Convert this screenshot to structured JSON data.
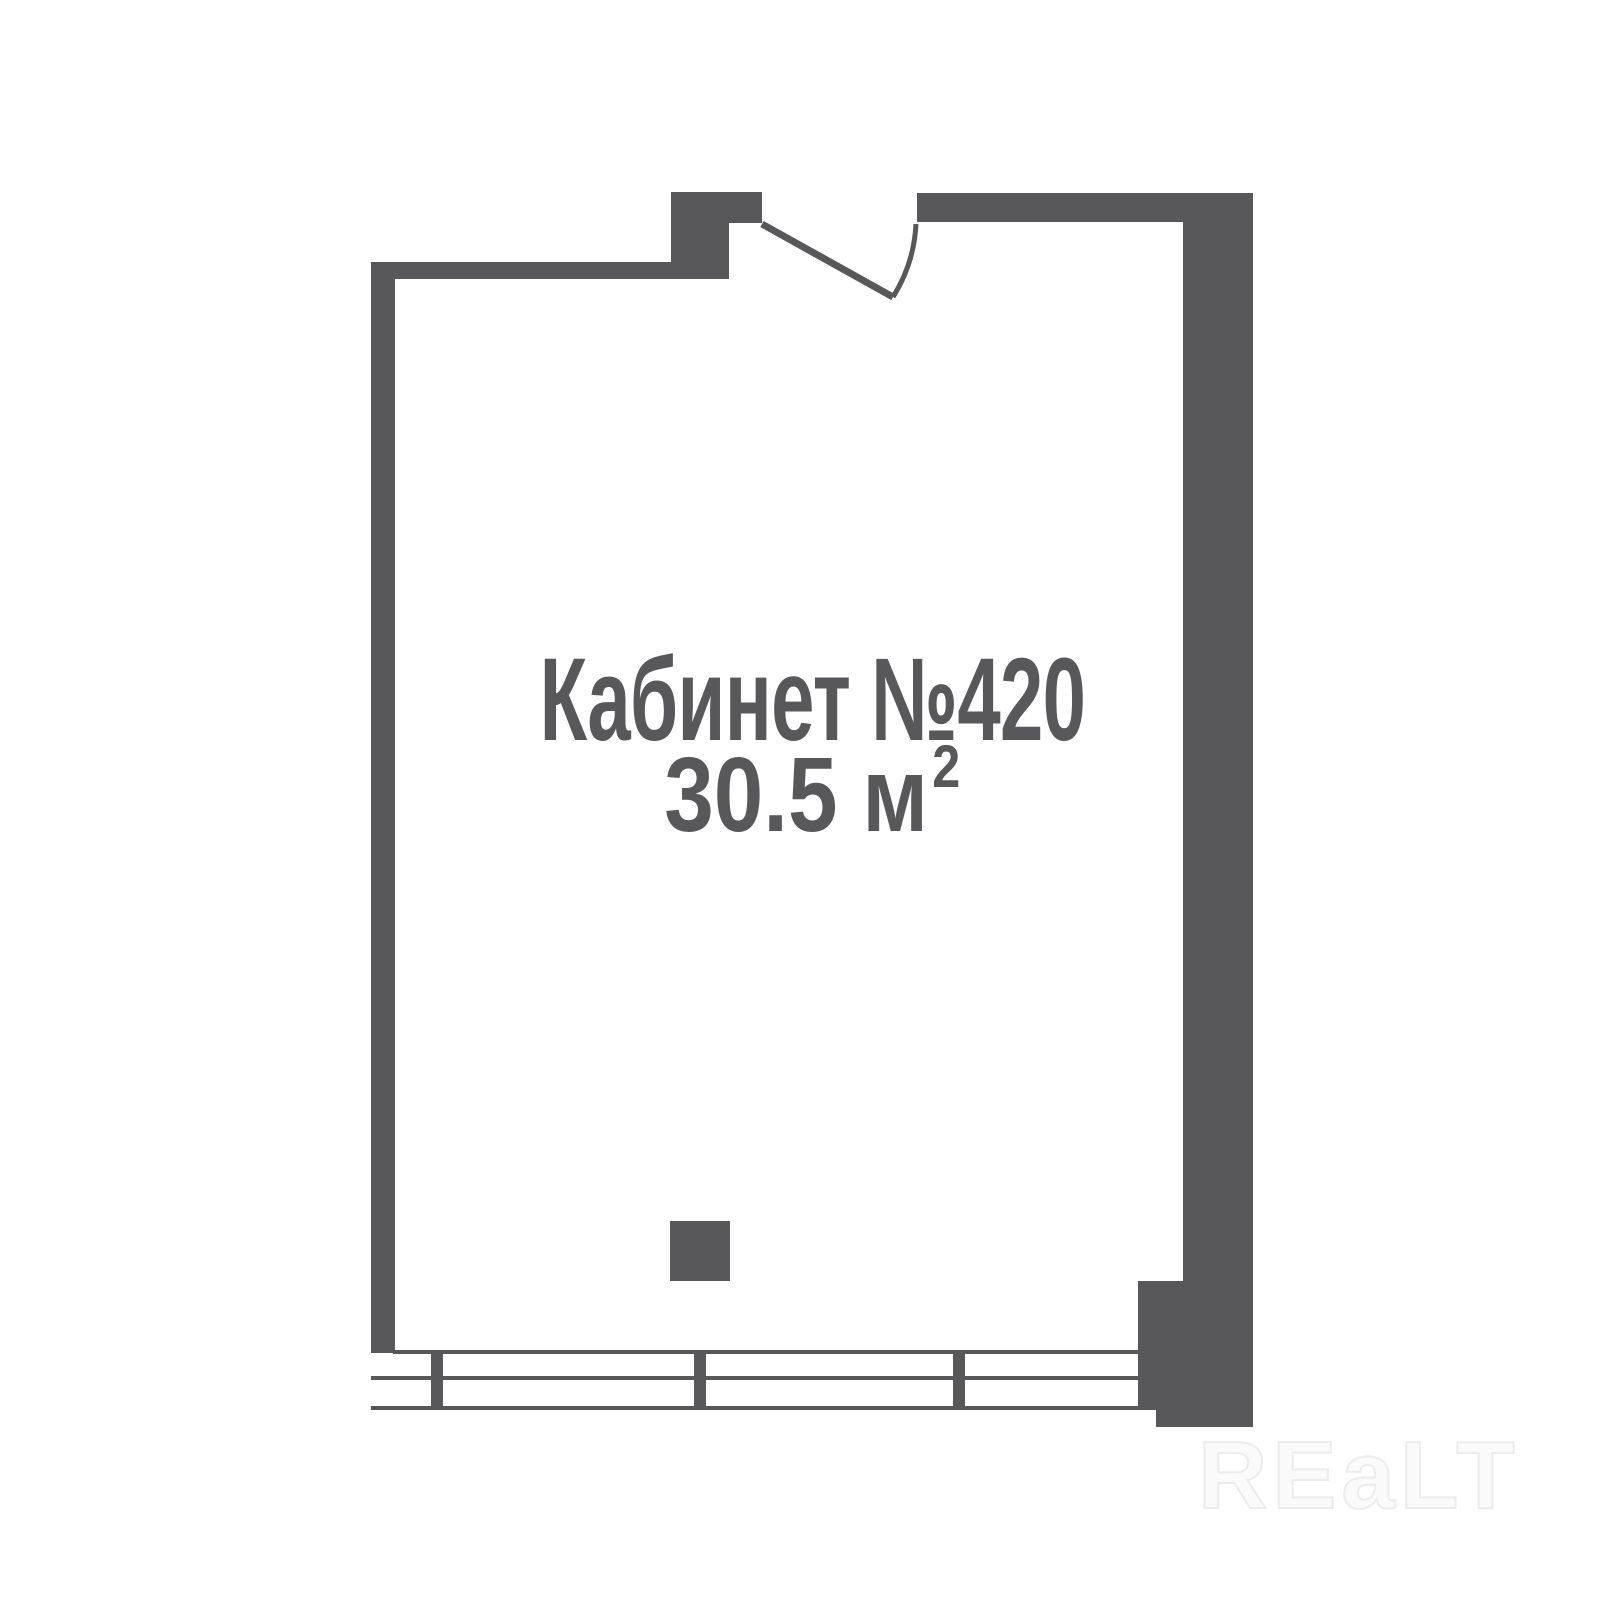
{
  "floor_plan": {
    "room": {
      "label": "Кабинет №420",
      "area_value": "30.5 м",
      "area_superscript": "2"
    },
    "watermark": {
      "text": "REaLT"
    },
    "colors": {
      "wall": "#58585a",
      "text": "#58585a",
      "watermark_outline": "#ececec",
      "background": "#ffffff"
    }
  }
}
